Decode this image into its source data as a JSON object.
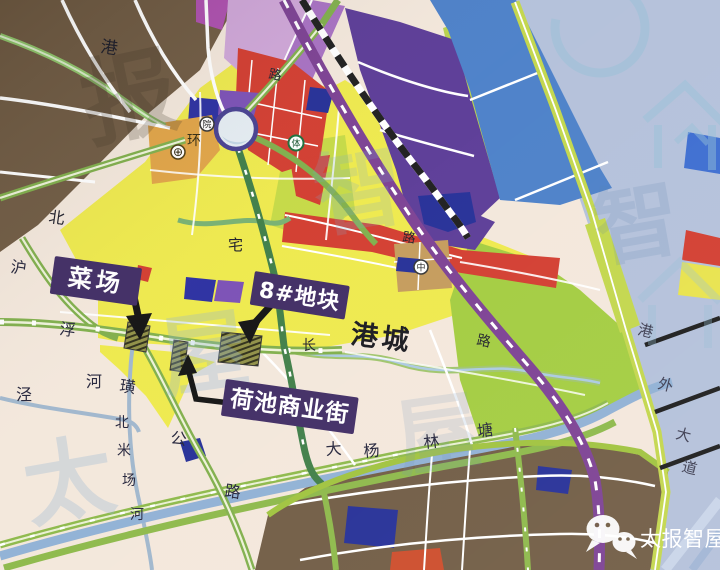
{
  "colors": {
    "outside": "#b3c0da",
    "cream": "#f3e7db",
    "brown": "#6f5a42",
    "yellow": "#eee94b",
    "lime": "#c5d944",
    "bright_green": "#a2cc3e",
    "red": "#d23b2e",
    "purple_block": "#5a3a96",
    "pink": "#cfa6d8",
    "blue_block": "#4a7fc8",
    "navy": "#232d96",
    "orange_strip": "#e0a345",
    "tan_block": "#c49a5a",
    "river": "#93b3d6",
    "road_green": "#7fae4a",
    "road_purple": "#7b3f92",
    "railway_black": "#1c1c1c",
    "callout_bg": "#3f2b63",
    "callout_text": "#ffffff",
    "brand_text": "#ffffff"
  },
  "callouts": [
    {
      "id": "caichang",
      "label": "菜场"
    },
    {
      "id": "plot8",
      "label": "8#地块"
    },
    {
      "id": "hechi",
      "label": "荷池商业街"
    }
  ],
  "labels": {
    "gangcheng": "港城",
    "gang_top": "港",
    "bei_left": "北",
    "lu_top": "路",
    "zhai": "宅",
    "lu_mid": "路",
    "huan": "环",
    "chang": "长",
    "lu_right": "路"
  },
  "road_names": {
    "hufuhuang_gonglu": [
      "沪",
      "浮",
      "璜",
      "公",
      "路"
    ],
    "gangwai_dadao": [
      "港",
      "外",
      "大",
      "道"
    ],
    "beimichang_river": [
      "北",
      "米",
      "场",
      "河"
    ],
    "dayanglintang": [
      "大",
      "杨",
      "林",
      "塘"
    ],
    "jinghe": [
      "泾",
      "河"
    ]
  },
  "poi_icons": [
    {
      "name": "hospital-cross-icon",
      "glyph": "⊕"
    },
    {
      "name": "yuan-circle-icon",
      "glyph": "院"
    },
    {
      "name": "sports-circle-icon",
      "glyph": "体"
    },
    {
      "name": "school-circle-icon",
      "glyph": "中"
    }
  ],
  "brand": {
    "name": "太报智屋"
  },
  "watermark_glyphs": [
    "报",
    "智",
    "屋",
    "太",
    "智",
    "屋"
  ]
}
